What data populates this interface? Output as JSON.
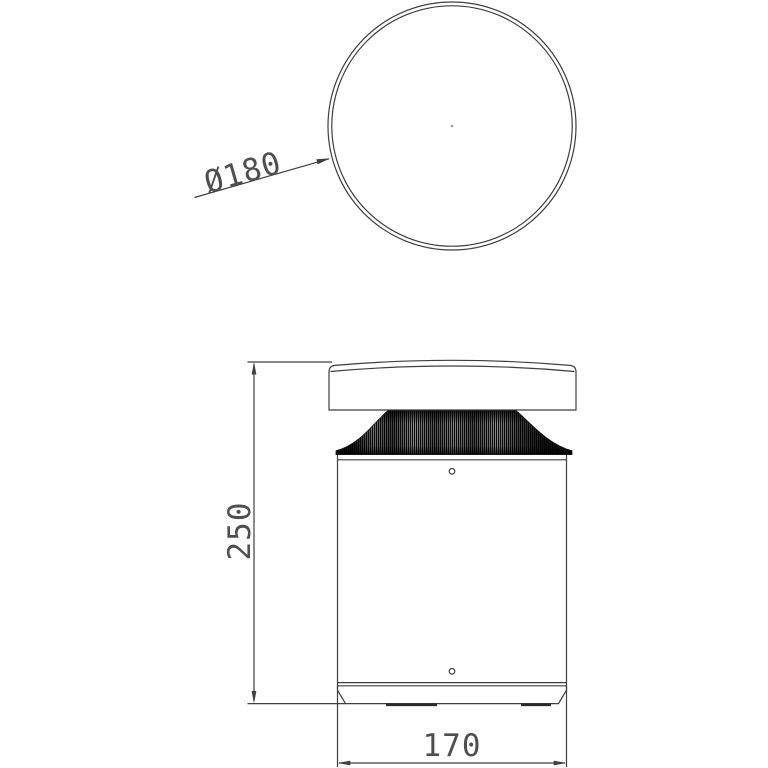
{
  "colors": {
    "background": "#ffffff",
    "line": "#3f3f3f",
    "text": "#4f4f4f"
  },
  "dimensions": {
    "diameter": "Ø180",
    "height": "250",
    "width": "170"
  }
}
